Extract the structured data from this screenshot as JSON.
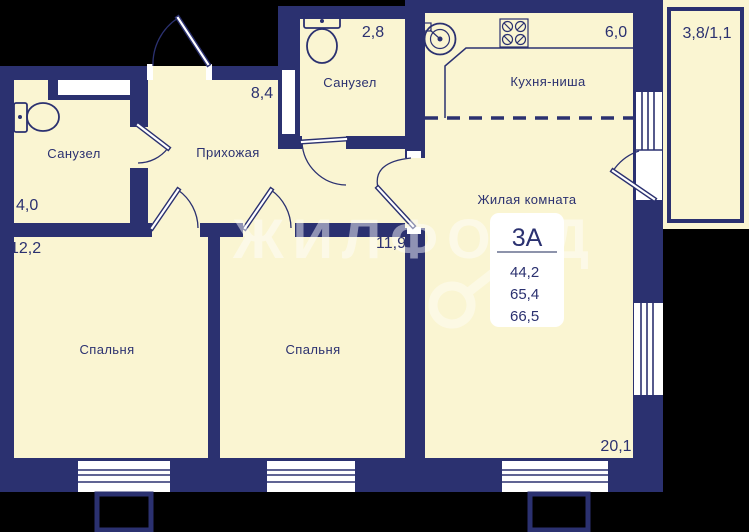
{
  "title": "Floor plan 3А",
  "colors": {
    "wall": "#2b3170",
    "room": "#faf5d2",
    "outside": "#000000",
    "white": "#ffffff",
    "text": "#2b3170",
    "divider": "#8d93ab"
  },
  "rooms": [
    {
      "id": "bathroom-left",
      "label": "Санузел",
      "area": "4,0"
    },
    {
      "id": "bathroom-top",
      "label": "Санузел",
      "area": "2,8"
    },
    {
      "id": "hallway",
      "label": "Прихожая",
      "area": "8,4"
    },
    {
      "id": "kitchen-niche",
      "label": "Кухня-ниша",
      "area": "6,0"
    },
    {
      "id": "living-room",
      "label": "Жилая комната",
      "area": "20,1"
    },
    {
      "id": "bedroom-1",
      "label": "Спальня",
      "area": "12,2"
    },
    {
      "id": "bedroom-2",
      "label": "Спальня",
      "area": "11,9"
    },
    {
      "id": "balcony",
      "label": "",
      "area": "3,8/1,1"
    }
  ],
  "apartment": {
    "unit": "3А",
    "areas": [
      "44,2",
      "65,4",
      "66,5"
    ]
  },
  "watermark": "ЖИЛФОНД",
  "icons": {
    "bathroom_left": "toilet-icon",
    "bathroom_top": "toilet-icon",
    "kitchen_sink": "sink-icon",
    "kitchen_stove": "stove-icon",
    "watermark_key": "key-icon"
  }
}
